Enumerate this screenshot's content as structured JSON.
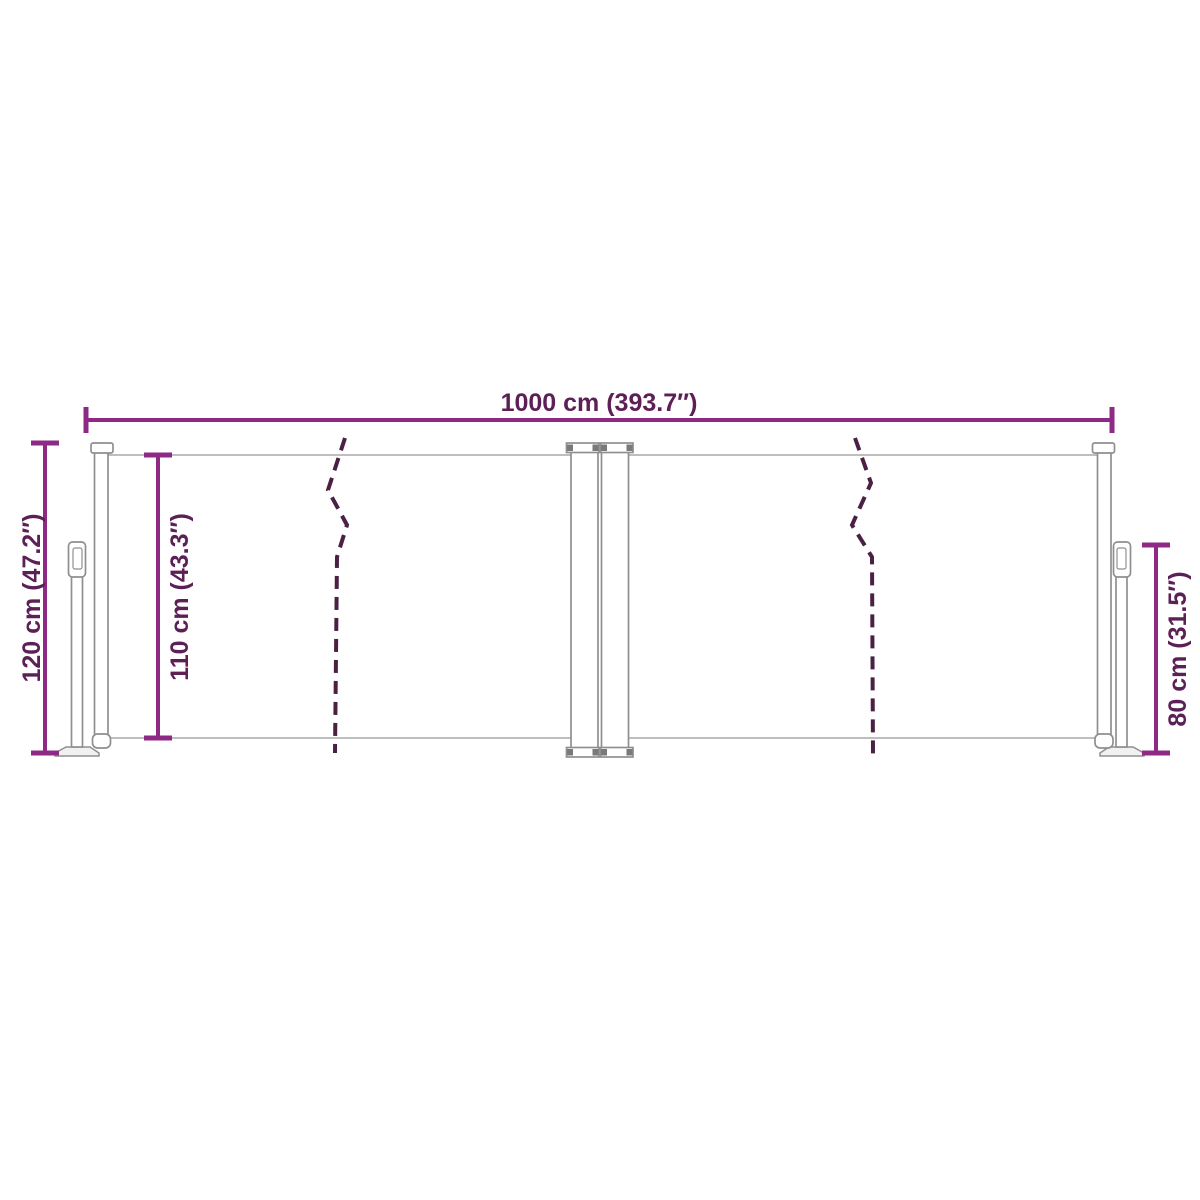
{
  "diagram": {
    "kind": "product-dimension-drawing",
    "labels": {
      "total_width": "1000 cm (393.7″)",
      "post_height": "120 cm (47.2″)",
      "fabric_height": "110 cm (43.3″)",
      "right_height": "80 cm (31.5″)"
    }
  },
  "colors": {
    "dimension_line": "#8E2A86",
    "dimension_text": "#5C2057",
    "break_line": "#4A2144",
    "outline": "#8F8F8F",
    "fabric_line": "#A8A8A8",
    "fill_light": "#F1F1F1",
    "block": "#7A7A7A",
    "background": "#FFFFFF"
  }
}
